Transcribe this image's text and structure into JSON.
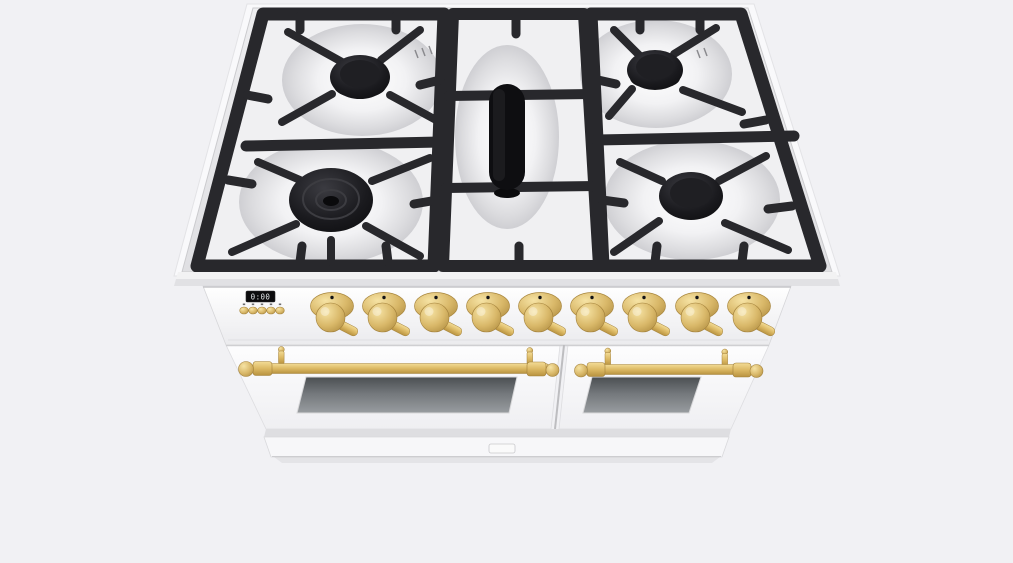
{
  "scene": {
    "subject": "white freestanding dual-oven gas range with brass trim, 3D render viewed from top-front",
    "background_color": "#f1f1f4"
  },
  "colors": {
    "background": "#f1f1f4",
    "body_white": "#fbfbfc",
    "steel_light": "#f1f1f3",
    "steel_dark": "#e2e2e5",
    "grate": "#28282c",
    "grate_dark": "#131316",
    "burner_cap": "#101013",
    "brass": "#dcb964",
    "brass_highlight": "#f3dc96",
    "brass_shadow": "#ad8a3e",
    "oven_window_top": "#53575a",
    "oven_window_bottom": "#95999c",
    "display_bg": "#0c0c0e",
    "display_text": "#dfe3e6",
    "seam": "#c6c6c9"
  },
  "cooktop": {
    "sections": [
      "left-grate",
      "center-grate",
      "right-grate"
    ],
    "burner_count": 5,
    "burners": [
      {
        "position": "back-left",
        "style": "round sealed burner, black cap"
      },
      {
        "position": "front-left",
        "style": "large multi-ring burner, black cap"
      },
      {
        "position": "center",
        "style": "oval griddle burner, black"
      },
      {
        "position": "back-right",
        "style": "round sealed burner, black cap"
      },
      {
        "position": "front-right",
        "style": "round sealed burner, black cap"
      }
    ],
    "grate_material": "black cast iron over stainless steel"
  },
  "control_panel": {
    "display": {
      "value": "0:00"
    },
    "button_count": 5,
    "knob_count": 9,
    "knob_finish": "brass"
  },
  "oven": {
    "door_count": 2,
    "doors": [
      {
        "side": "left",
        "width": "wide",
        "handle": "brass rail",
        "window": "dark glass"
      },
      {
        "side": "right",
        "width": "narrow",
        "handle": "brass rail",
        "window": "dark glass"
      }
    ],
    "drawer": {
      "present": true,
      "latch": true
    }
  }
}
